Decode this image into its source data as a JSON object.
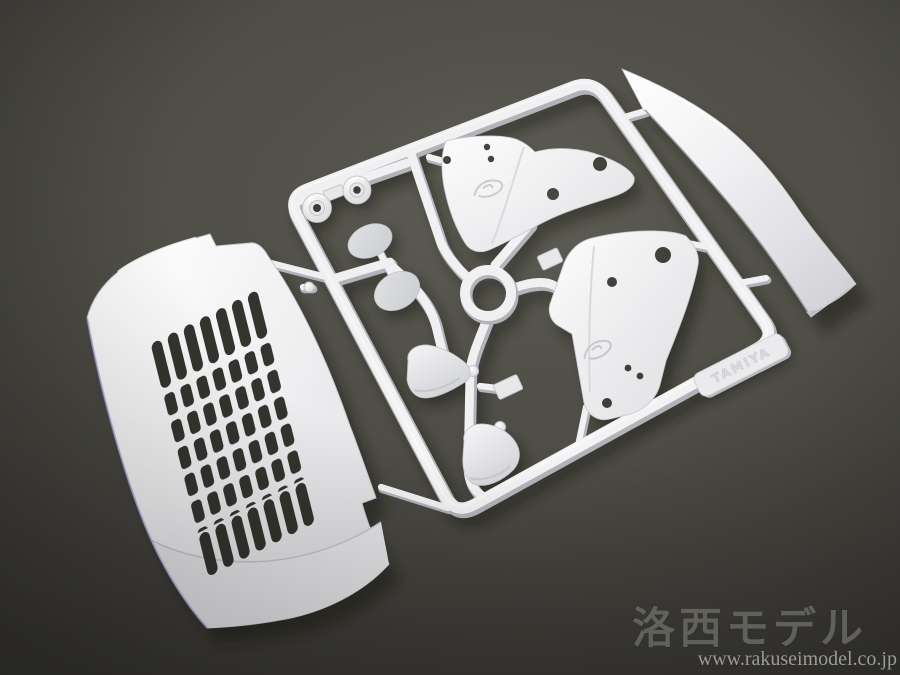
{
  "image": {
    "description": "Product photo of a white plastic model-kit sprue (runner) holding truck body parts, lying diagonally on a dark charcoal studio background"
  },
  "watermark": {
    "brand": "洛西モデル",
    "url": "www.rakuseimodel.co.jp"
  },
  "sprue": {
    "tag_text": "TAMIYA",
    "plastic_color_name": "white"
  },
  "parts": [
    {
      "id": "grille-panel",
      "label": "truck front grille panel with louver slots"
    },
    {
      "id": "visor-strip",
      "label": "long curved sun-visor strip"
    },
    {
      "id": "bracket-upper",
      "label": "mirror stay bracket (upper, with embossed logo and holes)"
    },
    {
      "id": "bracket-right",
      "label": "mirror stay bracket (right, with embossed logo and holes)"
    },
    {
      "id": "round-cap-left",
      "label": "round cap part"
    },
    {
      "id": "round-cap-right",
      "label": "round cap part"
    },
    {
      "id": "mirror-face-small",
      "label": "flat mirror face (small)"
    },
    {
      "id": "mirror-face-large",
      "label": "flat mirror face (large)"
    },
    {
      "id": "mirror-housing-upper",
      "label": "mirror housing shell (upper)"
    },
    {
      "id": "mirror-housing-lower",
      "label": "mirror housing shell (lower)"
    },
    {
      "id": "runner-ring",
      "label": "circular runner ring"
    },
    {
      "id": "molded-tag",
      "label": "molded maker tag on runner frame"
    }
  ],
  "colors": {
    "background_center": "#59584f",
    "background_edge": "#343330",
    "plastic_white": "#f3f3f5",
    "plastic_shade": "#c7c8cc",
    "runner_underside": "#b3b4b9",
    "hole_dark": "#34332e",
    "shadow": "#15140f",
    "watermark_brand": "#86867f",
    "watermark_url": "#a9a9a1"
  }
}
